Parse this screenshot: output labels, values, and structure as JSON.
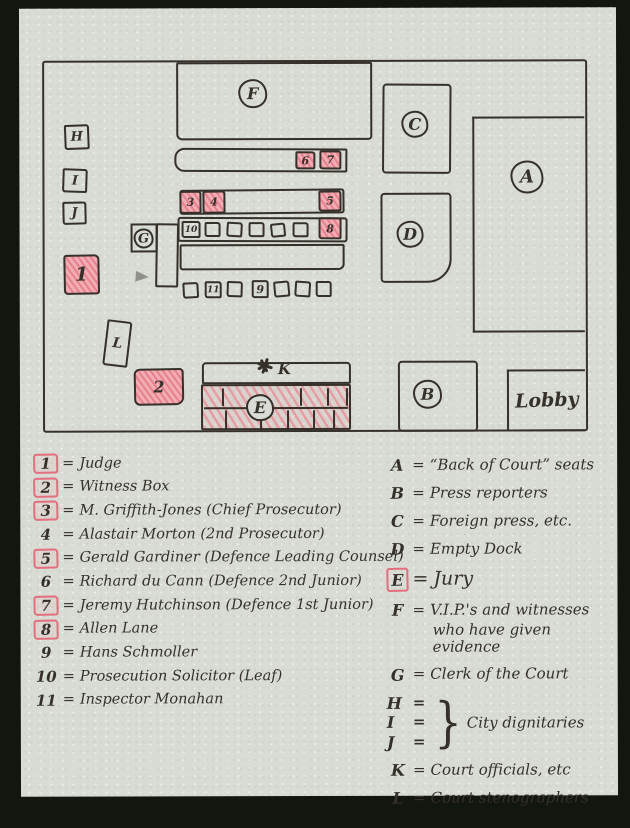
{
  "colors": {
    "bg": "#11160f",
    "paper": "#d8dcd5",
    "ink": "#36302a",
    "pink": "#f0a1aa",
    "pinkline": "#e46e7d"
  },
  "ui": {
    "eq": "=",
    "brace": "}"
  },
  "plan": {
    "a": "A",
    "b": "B",
    "c": "C",
    "d": "D",
    "e": "E",
    "f": "F",
    "g": "G",
    "h": "H",
    "i": "I",
    "j": "J",
    "k": "K",
    "l": "L",
    "lobby": "Lobby",
    "n1": "1",
    "n2": "2",
    "n3": "3",
    "n4": "4",
    "n5": "5",
    "n6": "6",
    "n7": "7",
    "n8": "8",
    "n9": "9",
    "n10": "10",
    "n11": "11"
  },
  "legend_left": [
    {
      "num": "1",
      "boxed": true,
      "text": "Judge"
    },
    {
      "num": "2",
      "boxed": true,
      "text": "Witness Box"
    },
    {
      "num": "3",
      "boxed": true,
      "text": "M. Griffith-Jones (Chief Prosecutor)"
    },
    {
      "num": "4",
      "boxed": false,
      "text": "Alastair Morton (2nd Prosecutor)"
    },
    {
      "num": "5",
      "boxed": true,
      "text": "Gerald Gardiner (Defence Leading Counsel)"
    },
    {
      "num": "6",
      "boxed": false,
      "text": "Richard du Cann (Defence 2nd Junior)"
    },
    {
      "num": "7",
      "boxed": true,
      "text": "Jeremy Hutchinson (Defence 1st Junior)"
    },
    {
      "num": "8",
      "boxed": true,
      "text": "Allen Lane"
    },
    {
      "num": "9",
      "boxed": false,
      "text": "Hans Schmoller"
    },
    {
      "num": "10",
      "boxed": false,
      "text": "Prosecution Solicitor (Leaf)"
    },
    {
      "num": "11",
      "boxed": false,
      "text": "Inspector Monahan"
    }
  ],
  "legend_right": [
    {
      "key": "A",
      "boxed": false,
      "text": "“Back of Court” seats"
    },
    {
      "key": "B",
      "boxed": false,
      "text": "Press reporters"
    },
    {
      "key": "C",
      "boxed": false,
      "text": "Foreign press, etc."
    },
    {
      "key": "D",
      "boxed": false,
      "text": "Empty Dock"
    },
    {
      "key": "E",
      "boxed": true,
      "text": "Jury"
    },
    {
      "key": "F",
      "boxed": false,
      "text": "V.I.P.'s and witnesses",
      "text2": "who have given evidence"
    },
    {
      "key": "G",
      "boxed": false,
      "text": "Clerk of the Court"
    },
    {
      "key": "HIJ",
      "keys": [
        "H",
        "I",
        "J"
      ],
      "text": "City dignitaries"
    },
    {
      "key": "K",
      "boxed": false,
      "text": "Court officials, etc"
    },
    {
      "key": "L",
      "boxed": false,
      "text": "Court stenographers"
    }
  ]
}
